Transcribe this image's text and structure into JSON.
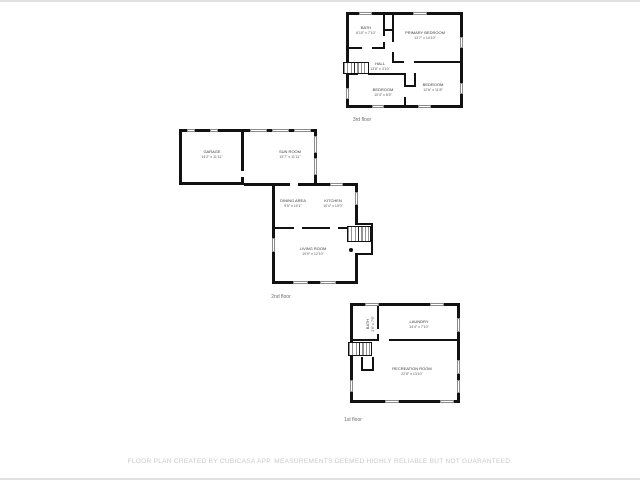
{
  "floors": [
    {
      "label": "3rd floor",
      "rooms": [
        {
          "name": "BATH",
          "dims": "6'10\" x 7'10\""
        },
        {
          "name": "PRIMARY BEDROOM",
          "dims": "13'7\" x 14'10\""
        },
        {
          "name": "HALL",
          "dims": "13'8\" x 3'10\""
        },
        {
          "name": "BEDROOM",
          "dims": "12'6\" x 11'8\""
        },
        {
          "name": "BEDROOM",
          "dims": "10'4\" x 8'5\""
        }
      ]
    },
    {
      "label": "2nd floor",
      "rooms": [
        {
          "name": "GARAGE",
          "dims": "14'2\" x 11'11\""
        },
        {
          "name": "SUN ROOM",
          "dims": "15'7\" x 11'11\""
        },
        {
          "name": "DINING AREA",
          "dims": "9'5\" x 10'1\""
        },
        {
          "name": "KITCHEN",
          "dims": "10'4\" x 10'0\""
        },
        {
          "name": "LIVING ROOM",
          "dims": "19'9\" x 12'10\""
        }
      ]
    },
    {
      "label": "1st floor",
      "rooms": [
        {
          "name": "BATH",
          "dims": "3'6\" x 7'6\""
        },
        {
          "name": "LAUNDRY",
          "dims": "14'4\" x 7'10\""
        },
        {
          "name": "RECREATION ROOM",
          "dims": "22'8\" x 13'10\""
        }
      ]
    }
  ],
  "footer": {
    "disclaimer": "FLOOR PLAN CREATED BY CUBICASA APP. MEASUREMENTS DEEMED HIGHLY RELIABLE BUT NOT GUARANTEED."
  },
  "colors": {
    "wall": "#121212",
    "window_outline": "#8c8c8c",
    "room_text": "#3a3a3a",
    "floor_label_text": "#6b6b6b",
    "disclaimer_text": "#c9c9c9"
  }
}
